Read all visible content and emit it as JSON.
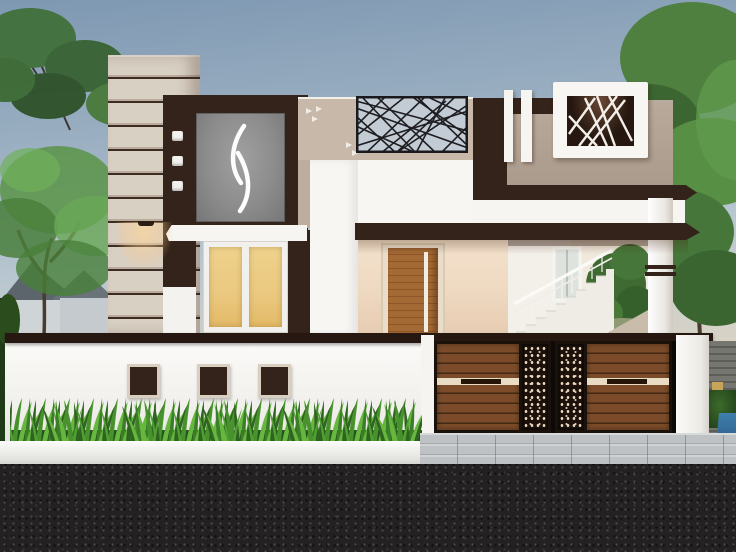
{
  "scene": {
    "title": "modern-house-front-elevation-render",
    "time_of_day": "dusk",
    "house": {
      "striped_pillar_stripes": 11,
      "ornament_squares": 3,
      "wall_accent_squares": 3,
      "white_vertical_bars": 2,
      "window_panes": 2,
      "doors": 1,
      "gate_leaves": 2,
      "gate_perforated_panels": 2,
      "lattice_screens": 1,
      "feature_light_boxes": 1,
      "staircase_visible": true,
      "downlights": 1
    },
    "landscape": {
      "trees_left": 2,
      "trees_right": 1,
      "hedge_row": true,
      "neighbor_houses": 2,
      "road_foreground": true,
      "paved_driveway": true
    }
  },
  "palette": {
    "sky_top": "#7e98b2",
    "sky_mid": "#b7c6d0",
    "sky_horizon": "#ecd6ba",
    "dark_brown": "#33231a",
    "dark_brown_deep": "#261811",
    "column_beige": "#d9d0c4",
    "column_gap": "#3c2d22",
    "beige_panel": "#c7b8a9",
    "taupe_panel": "#b3a496",
    "glass_amber": "#eac87f",
    "cream_wall": "#f4e2cd",
    "cream_wall_deep": "#e6cbb0",
    "door_wood": "#a46a35",
    "gate_wood": "#7c4c2a",
    "gate_wood_dark": "#452915",
    "deco_dot": "#ead9bf",
    "hedge_dark": "#2e6420",
    "hedge_mid": "#47922c",
    "hedge_light": "#67b73e",
    "road": "#242122",
    "paver": "#bfc2c4",
    "blue_object": "#3f7fae"
  }
}
